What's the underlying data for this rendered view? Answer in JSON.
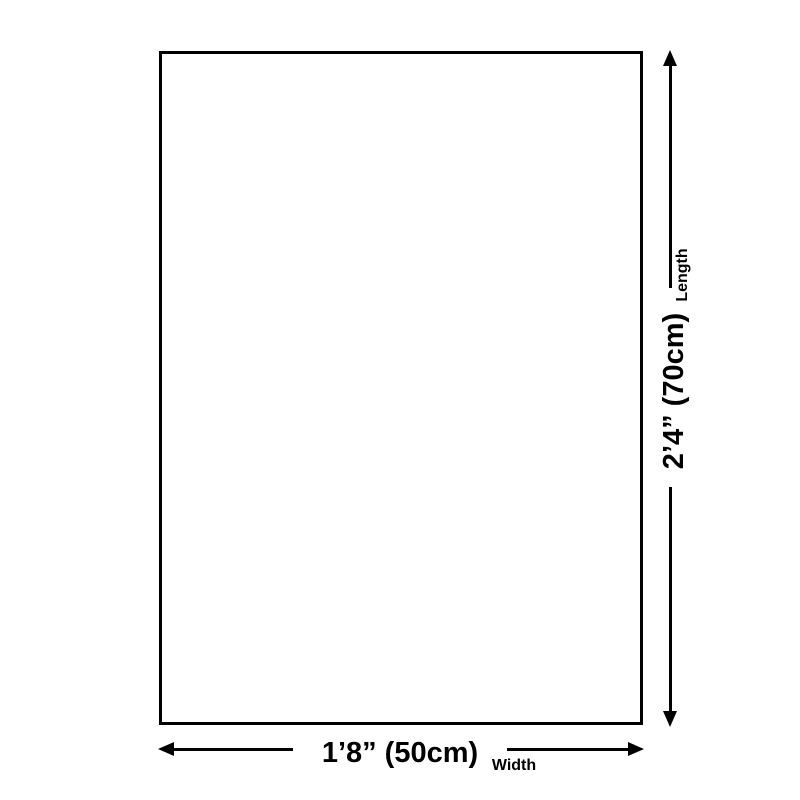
{
  "diagram": {
    "background_color": "#ffffff",
    "line_color": "#000000",
    "length_dimension": {
      "value": "2’4” (70cm)",
      "label": "Length"
    },
    "width_dimension": {
      "value": "1’8” (50cm)",
      "label": "Width"
    }
  }
}
